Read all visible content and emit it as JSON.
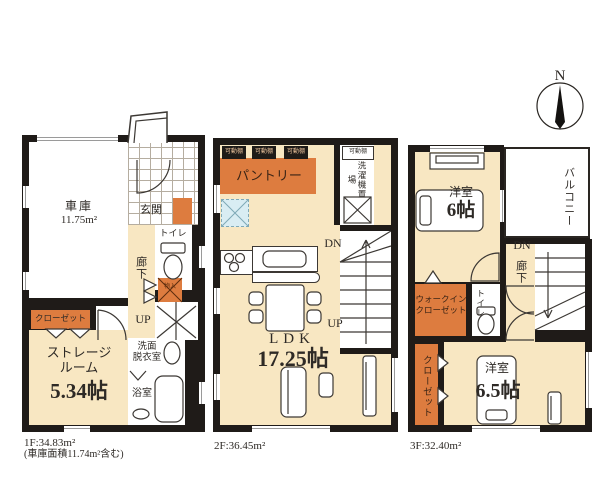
{
  "palette": {
    "wall": "#1f1b18",
    "floor_cream": "#f8e7c2",
    "accent_orange": "#dd7c3f",
    "appliance_blue": "#d9edf3",
    "line": "#3c3834"
  },
  "compass": {
    "north": "N"
  },
  "f1": {
    "garage_name": "車庫",
    "garage_size": "11.75m²",
    "entrance": "玄関",
    "toilet": "トイレ",
    "hall": "廊下",
    "small_storage": "物入",
    "up": "UP",
    "closet": "クローゼット",
    "storage_line1": "ストレージ",
    "storage_line2": "ルーム",
    "storage_size": "5.34帖",
    "wash_line1": "洗面",
    "wash_line2": "脱衣室",
    "bath": "浴室",
    "area": "1F:34.83m²",
    "area_note": "(車庫面積11.74m²含む)"
  },
  "f2": {
    "shelf": "可動棚",
    "pantry": "パントリー",
    "laundry": "洗濯機置場",
    "dn": "DN",
    "up": "UP",
    "ldk_name": "LDK",
    "ldk_size": "17.25帖",
    "area": "2F:36.45m²"
  },
  "f3": {
    "bedroom1_name": "洋室",
    "bedroom1_size": "6帖",
    "balcony": "バルコニー",
    "dn": "DN",
    "hall": "廊下",
    "wic_line1": "ウォークイン",
    "wic_line2": "クローゼット",
    "toilet": "トイレ",
    "closet": "クローゼット",
    "bedroom2_name": "洋室",
    "bedroom2_size": "6.5帖",
    "area": "3F:32.40m²"
  }
}
